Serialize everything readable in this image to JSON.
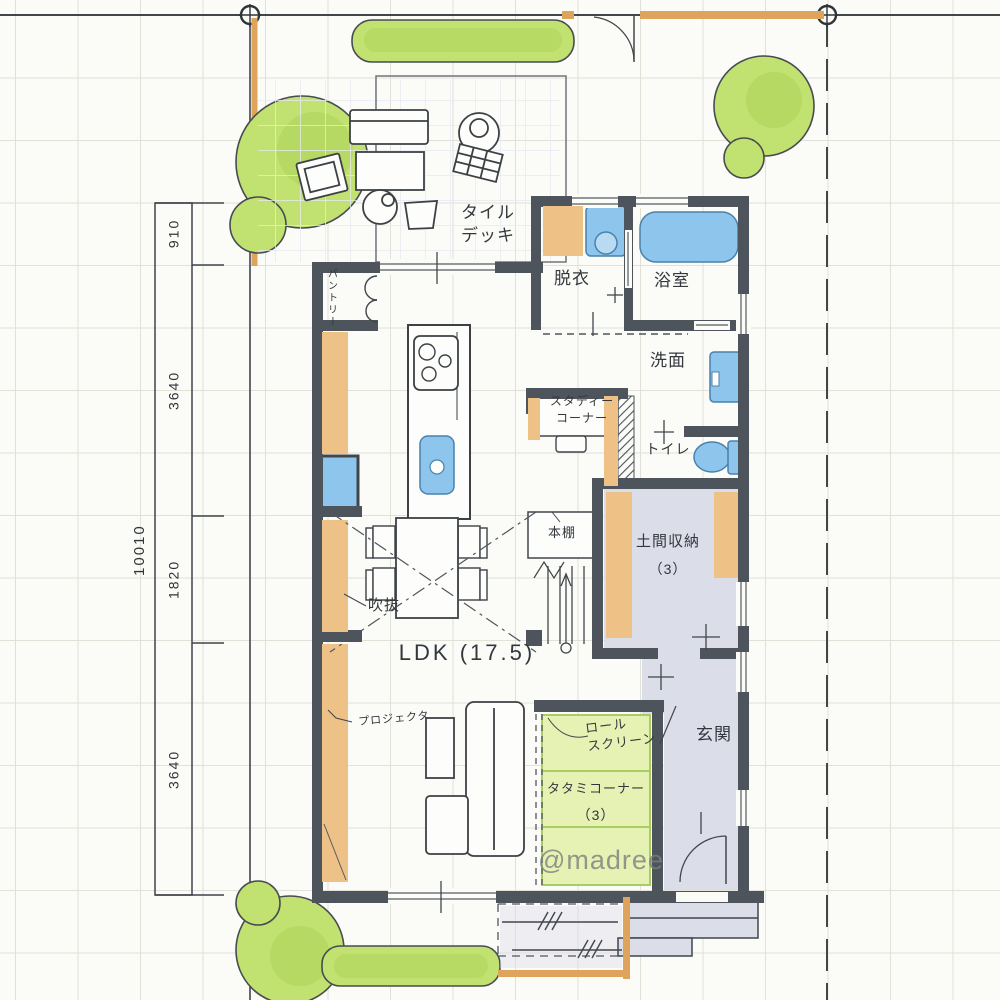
{
  "title": "hand-drawn floor plan",
  "labels": {
    "tile_deck": "タイル\nデッキ",
    "pantry": "パントリー",
    "changing_room": "脱衣",
    "bathroom": "浴室",
    "washroom": "洗面",
    "study_corner": "スタディー\nコーナー",
    "toilet": "トイレ",
    "doma_storage": "土間収納",
    "doma_size": "（3）",
    "bookshelf": "本棚",
    "void": "吹抜",
    "ldk": "LDK (17.5)",
    "projector": "プロジェクタ",
    "roll_screen": "ロール\nスクリーン",
    "tatami_corner": "タタミコーナー",
    "tatami_size": "（3）",
    "entrance": "玄関",
    "watermark": "@madree"
  },
  "dimensions": {
    "total": "10010",
    "segments": [
      "910",
      "3640",
      "1820",
      "3640"
    ]
  },
  "colors": {
    "paper": "#fbfbf8",
    "ink": "#41464b",
    "wall": "#4d545b",
    "wood_accent": "#eec187",
    "fence_orange": "#dfa45c",
    "fixture_blue": "#8ec5ec",
    "tree_green": "#c1e171",
    "tatami_green": "#e6f2b4",
    "floor_lavender": "#dbdde9",
    "watermark_gray": "#7d7d7d"
  }
}
